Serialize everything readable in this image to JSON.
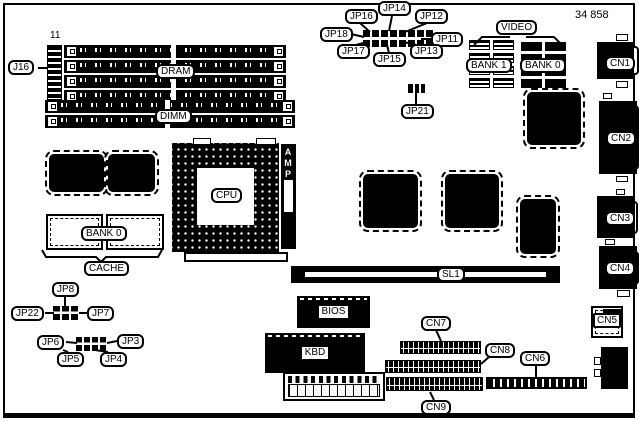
{
  "diagram": {
    "part_number": "34 858",
    "memory": {
      "pin11": "11",
      "j16": "J16",
      "dram": "DRAM",
      "dimm": "DIMM"
    },
    "top_jumpers": {
      "jp16": "JP16",
      "jp14": "JP14",
      "jp12": "JP12",
      "jp18": "JP18",
      "jp11": "JP11",
      "jp17": "JP17",
      "jp15": "JP15",
      "jp13": "JP13",
      "jp21": "JP21"
    },
    "video": {
      "section": "VIDEO",
      "bank1": "BANK 1",
      "bank0": "BANK 0"
    },
    "cpu": {
      "cpu": "CPU",
      "amp": "AMP"
    },
    "cache": {
      "bank0": "BANK 0",
      "cache": "CACHE"
    },
    "chips": {
      "bios": "BIOS",
      "kbd": "KBD"
    },
    "slot": {
      "sl1": "SL1"
    },
    "connectors": {
      "cn1": "CN1",
      "cn2": "CN2",
      "cn3": "CN3",
      "cn4": "CN4",
      "cn5": "CN5",
      "cn6": "CN6",
      "cn7": "CN7",
      "cn8": "CN8",
      "cn9": "CN9"
    },
    "left_jumpers": {
      "jp8": "JP8",
      "jp22": "JP22",
      "jp7": "JP7",
      "jp6": "JP6",
      "jp5": "JP5",
      "jp4": "JP4",
      "jp3": "JP3"
    }
  },
  "colors": {
    "ink": "#000000",
    "paper": "#ffffff"
  }
}
